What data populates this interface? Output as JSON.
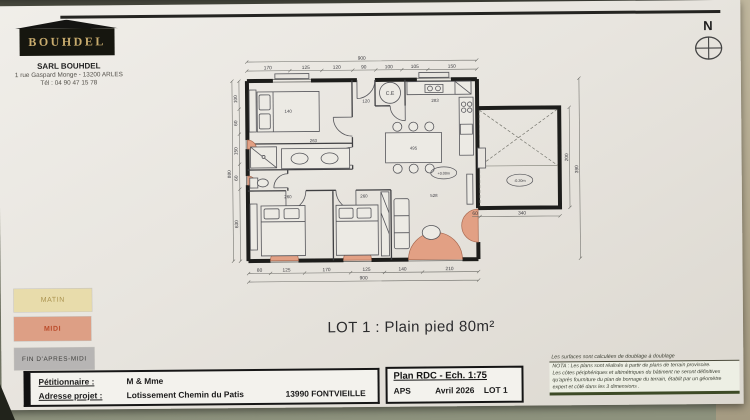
{
  "letterhead": {
    "logo": "BOUHDEL",
    "company": "SARL BOUHDEL",
    "address": "1 rue Gaspard Monge - 13200 ARLES",
    "phone": "Tél : 04 90 47 15 78"
  },
  "north_label": "N",
  "plan": {
    "labels": {
      "ce": "C.E",
      "level_interior": "+0.00m",
      "level_terrace": "-0.20m"
    },
    "dims": {
      "overall_top": "900",
      "overall_bottom": "900",
      "overall_left": "880",
      "top": [
        "170",
        "125",
        "120",
        "90",
        "100",
        "105",
        "150"
      ],
      "bottom": [
        "80",
        "125",
        "170",
        "125",
        "140",
        "210"
      ],
      "left": [
        "100",
        "60",
        "150",
        "60",
        "630"
      ],
      "right": [
        "200",
        "390"
      ],
      "terrace_small": "60",
      "terrace": "340",
      "interior": {
        "bed1": "140",
        "bath": "263",
        "bed2": "260",
        "bed3": "260",
        "living": "528",
        "kitchen": "283",
        "table": "495",
        "entry": "120"
      }
    }
  },
  "title": "LOT 1 : Plain pied 80m²",
  "legend": {
    "items": [
      {
        "label": "MATIN",
        "bg": "#e8dcab",
        "fg": "#ab9450"
      },
      {
        "label": "MIDI",
        "bg": "#dd9f85",
        "fg": "#bb4b2a"
      },
      {
        "label": "FIN D'APRES-MIDI",
        "bg": "#b7b5b4",
        "fg": "#3f3f3d"
      }
    ]
  },
  "titleblock": {
    "petitionnaire_label": "Pétitionnaire :",
    "petitionnaire_value": "M & Mme",
    "adresse_label": "Adresse projet :",
    "adresse_value": "Lotissement Chemin du Patis",
    "city": "13990 FONTVIEILLE",
    "plan_title": "Plan RDC - Ech. 1:75",
    "phase": "APS",
    "date": "Avril 2026",
    "lot": "LOT 1"
  },
  "notes": {
    "surfaces": "Les surfaces sont calculées de doublage à doublage",
    "nota1": "NOTA : Les plans sont réalisés à partir de plans de terrain provisoire.",
    "nota2": "Les côtes périphériques et altimétriques du bâtiment ne seront définitives",
    "nota3": "qu'après fourniture du plan de bornage du terrain, établit par un géomètre",
    "nota4": "expert et côté dans les 3 dimensions ."
  }
}
